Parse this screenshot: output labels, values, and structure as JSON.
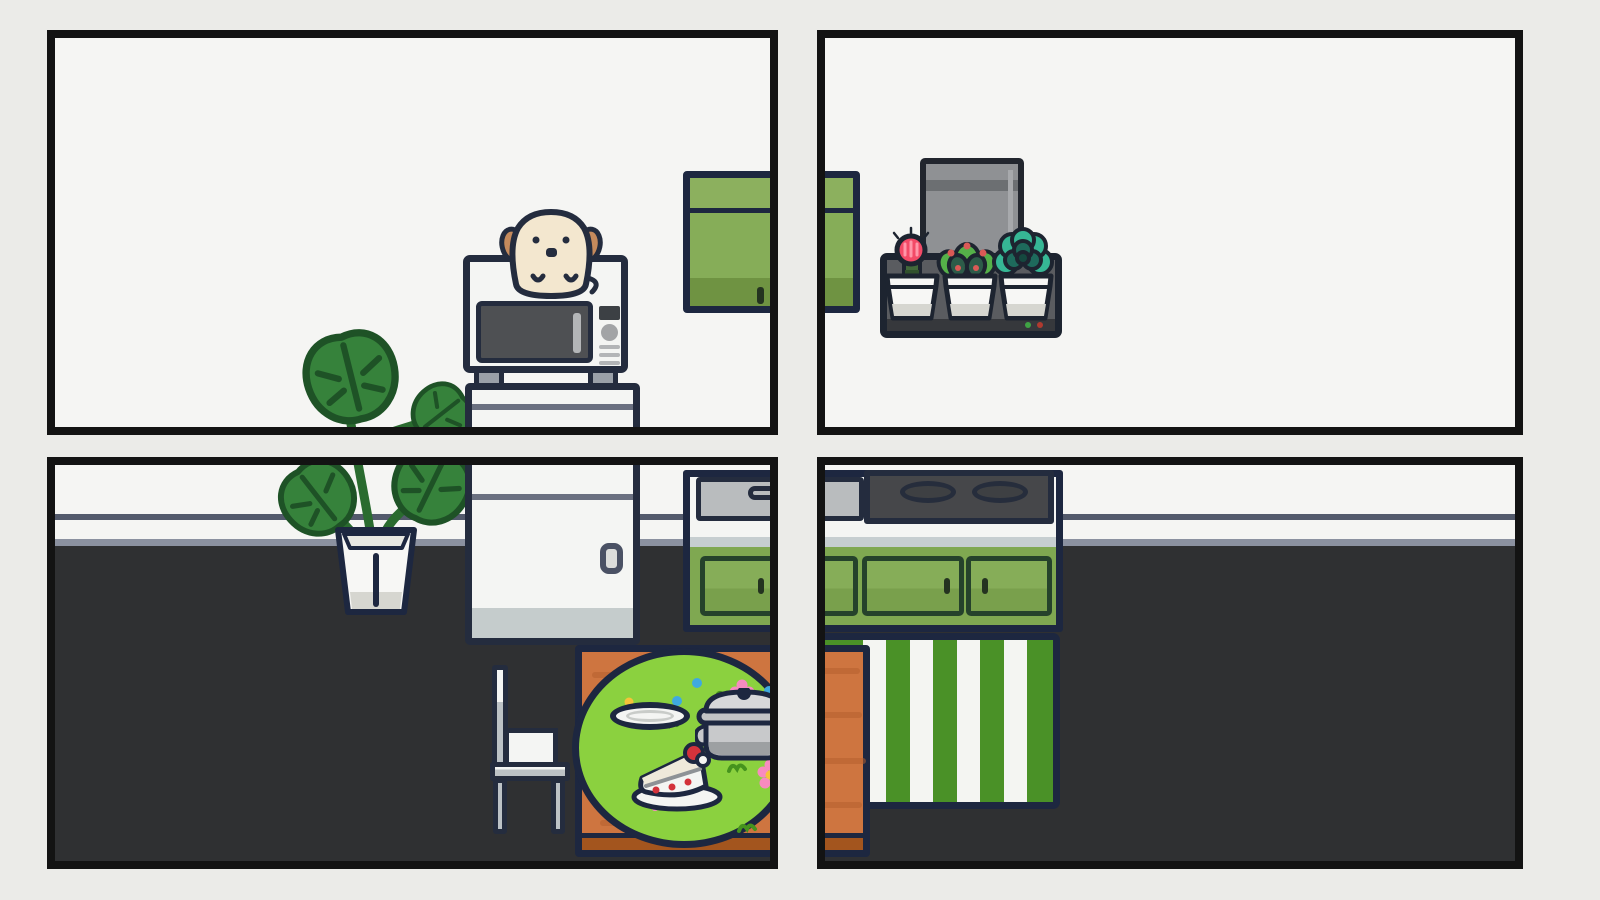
{
  "scene": {
    "title": "four-panel cozy kitchen room view",
    "panels": [
      {
        "id": "top-left",
        "objects": [
          "puppy peeking over microwave",
          "microwave",
          "mini fridge top",
          "green wall cabinet",
          "monstera leaves"
        ]
      },
      {
        "id": "top-right",
        "objects": [
          "green wall cabinet edge",
          "grey appliance",
          "wall shelf with three potted succulents",
          "two indicator leds"
        ]
      },
      {
        "id": "bottom-left",
        "objects": [
          "monstera plant in white pot",
          "mini fridge",
          "white chair",
          "wooden table with round green tablecloth",
          "empty plate",
          "cooking pot",
          "strawberry cake slice",
          "sink counter",
          "green base cabinet",
          "striped rug edge"
        ]
      },
      {
        "id": "bottom-right",
        "objects": [
          "cooktop with two burners",
          "green base cabinet doors",
          "green and white striped rug",
          "wooden table edge"
        ]
      }
    ],
    "counts": {
      "burners": 2,
      "succulent_pots": 3,
      "shelf_leds": 2,
      "rug_stripes": 9
    },
    "succulents": [
      "pink moon cactus",
      "green succulent with red tips",
      "teal echeveria"
    ],
    "shelf_leds": [
      "green",
      "red"
    ]
  },
  "colors": {
    "bg": "#ebebe8",
    "panel-border": "#131313",
    "wall": "#f5f5f3",
    "floor": "#2f3032",
    "baseboard-dark": "#535a6c",
    "baseboard-light": "#8b91a0",
    "outline": "#1d2740",
    "outline-soft": "#242c3e",
    "cabinet-green": "#7fa851",
    "cabinet-green-light": "#8cb05e",
    "cabinet-green-door": "#86ad58",
    "cabinet-green-shade": "#6f9342",
    "cabinet-green-shade2": "#79a04c",
    "door-outline": "#25422b",
    "handle-dark": "#243320",
    "white-appliance": "#f4f5f3",
    "seam-grey": "#6a7080",
    "fridge-band": "#c5cccc",
    "fridge-handle": "#dcdddb",
    "fridge-handle-edge": "#4a5164",
    "mw-door": "#4e5053",
    "mw-display": "#3c4044",
    "mw-grey": "#a2a4a6",
    "mw-btn": "#b3b5b7",
    "foot-grey": "#9aa0a8",
    "counter-grey": "#c6ced0",
    "sink-grey": "#b9bcbe",
    "cooktop": "#46474a",
    "burner": "#3e4043",
    "burner-edge": "#262d3c",
    "rug-green": "#4a9127",
    "rug-white": "#f4f5f2",
    "table-wood": "#ce7540",
    "table-grain": "#b55f2e",
    "table-shade": "#a3551e",
    "cloth-green": "#8bd13f",
    "cloth-squiggle": "#45931d",
    "flower-pink": "#f78bc0",
    "flower-center": "#f6c33a",
    "dot-blue": "#3fa9e0",
    "leaf": "#36823b",
    "leaf-dark": "#1e5226",
    "stem": "#2a6b2f",
    "pot-white": "#f7f7f5",
    "pot-shade": "#d6d6d0",
    "dog-cream": "#f3e7cf",
    "dog-ear": "#c58a5c",
    "grey-app": "#8f9194",
    "grey-app-band": "#6c6f72",
    "grey-app-hl": "#a7a9ac",
    "grey-app-edge": "#22262e",
    "shelf": "#5a5c60",
    "shelf-bar": "#36383c",
    "shelf-edge": "#1d2430",
    "led-green": "#3fa344",
    "led-red": "#b03a2f",
    "cactus-pink": "#f34a67",
    "cactus-stripe": "#ff96a8",
    "cactus-stem": "#42683a",
    "cactus-stem-dark": "#31512c",
    "succ-green": "#55b049",
    "succ-dark": "#2d5c49",
    "succ-red": "#da5a56",
    "ech-teal": "#36b795",
    "ech-mid": "#1e6a5c",
    "ech-dark": "#15483f",
    "chair-grey": "#bcc2c6",
    "pot-metal": "#c8c9cb",
    "pot-metal-dark": "#9da0a2",
    "pot-lid": "#d7d8da",
    "pot-rim": "#c2c3c5",
    "cake-cream": "#efe9da",
    "cake-red": "#d3323b",
    "cake-layer": "#8e9296",
    "plate-rim": "#c9ccc9"
  }
}
